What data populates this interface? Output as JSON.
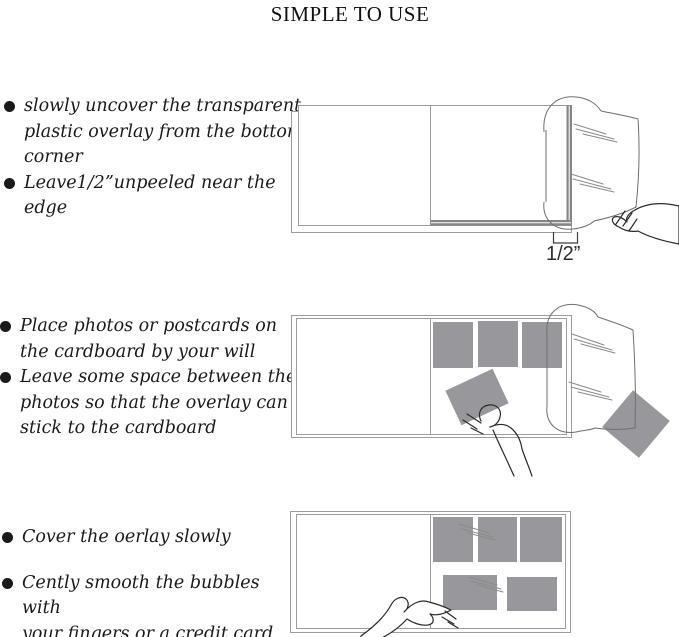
{
  "title": "SIMPLE TO USE",
  "sections": [
    {
      "items": [
        {
          "text": "slowly uncover the transparent\nplastic overlay from the bottom\ncorner"
        },
        {
          "text": "Leave1/2”unpeeled near the\nedge"
        }
      ]
    },
    {
      "items": [
        {
          "text": "Place photos or postcards on\nthe cardboard by your will"
        },
        {
          "text": "Leave some space between the\nphotos so that the overlay can\nstick to the cardboard"
        }
      ]
    },
    {
      "items": [
        {
          "text": "Cover the oerlay slowly"
        },
        {
          "text": "Cently smooth the bubbles with\nyour fingers or a credit card"
        }
      ]
    }
  ],
  "figure1": {
    "measure_label": "1/2”"
  },
  "colors": {
    "photo_gray": "#98989c",
    "adhesive_strip": "#85858a",
    "outline": "#9c9c9c",
    "hand_line": "#2a2a2a",
    "overlay_line": "#6f6f6f",
    "text_ink": "#1a1a1a"
  }
}
